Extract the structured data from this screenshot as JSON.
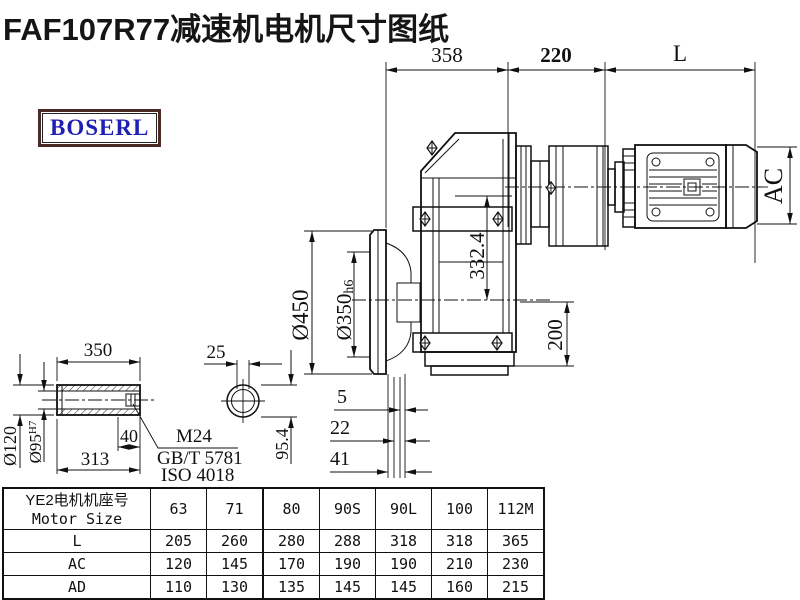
{
  "page": {
    "title": "FAF107R77减速机电机尺寸图纸",
    "brand": "BOSERL"
  },
  "colors": {
    "line": "#111111",
    "brand_text": "#1f1fb4",
    "brand_border": "#4b2b26"
  },
  "dims": {
    "gearbox_length": "358",
    "adapter_length": "220",
    "motor_length": "L",
    "motor_diameter": "AC",
    "axis_distance": "332.4",
    "axis_to_base": "200",
    "flange_diameter": "Ø450",
    "spigot_diameter": "Ø350",
    "spigot_tolerance": "h6",
    "face_offset_1": "5",
    "face_offset_2": "22",
    "face_offset_3": "41",
    "shaft_length": "350",
    "keyway_width": "25",
    "thread_depth": "40",
    "bore_depth": "313",
    "hub_diameter": "Ø120",
    "bore_diameter": "Ø95",
    "bore_tolerance": "H7",
    "end_height": "95.4",
    "thread_spec": "M24",
    "standard_1": "GB/T 5781",
    "standard_2": "ISO 4018"
  },
  "table": {
    "header_line1": "YE2电机机座号",
    "header_line2": "Motor Size",
    "columns": [
      "63",
      "71",
      "80",
      "90S",
      "90L",
      "100",
      "112M"
    ],
    "rows": [
      {
        "label": "L",
        "values": [
          "205",
          "260",
          "280",
          "288",
          "318",
          "318",
          "365"
        ]
      },
      {
        "label": "AC",
        "values": [
          "120",
          "145",
          "170",
          "190",
          "190",
          "210",
          "230"
        ]
      },
      {
        "label": "AD",
        "values": [
          "110",
          "130",
          "135",
          "145",
          "145",
          "160",
          "215"
        ]
      }
    ]
  }
}
